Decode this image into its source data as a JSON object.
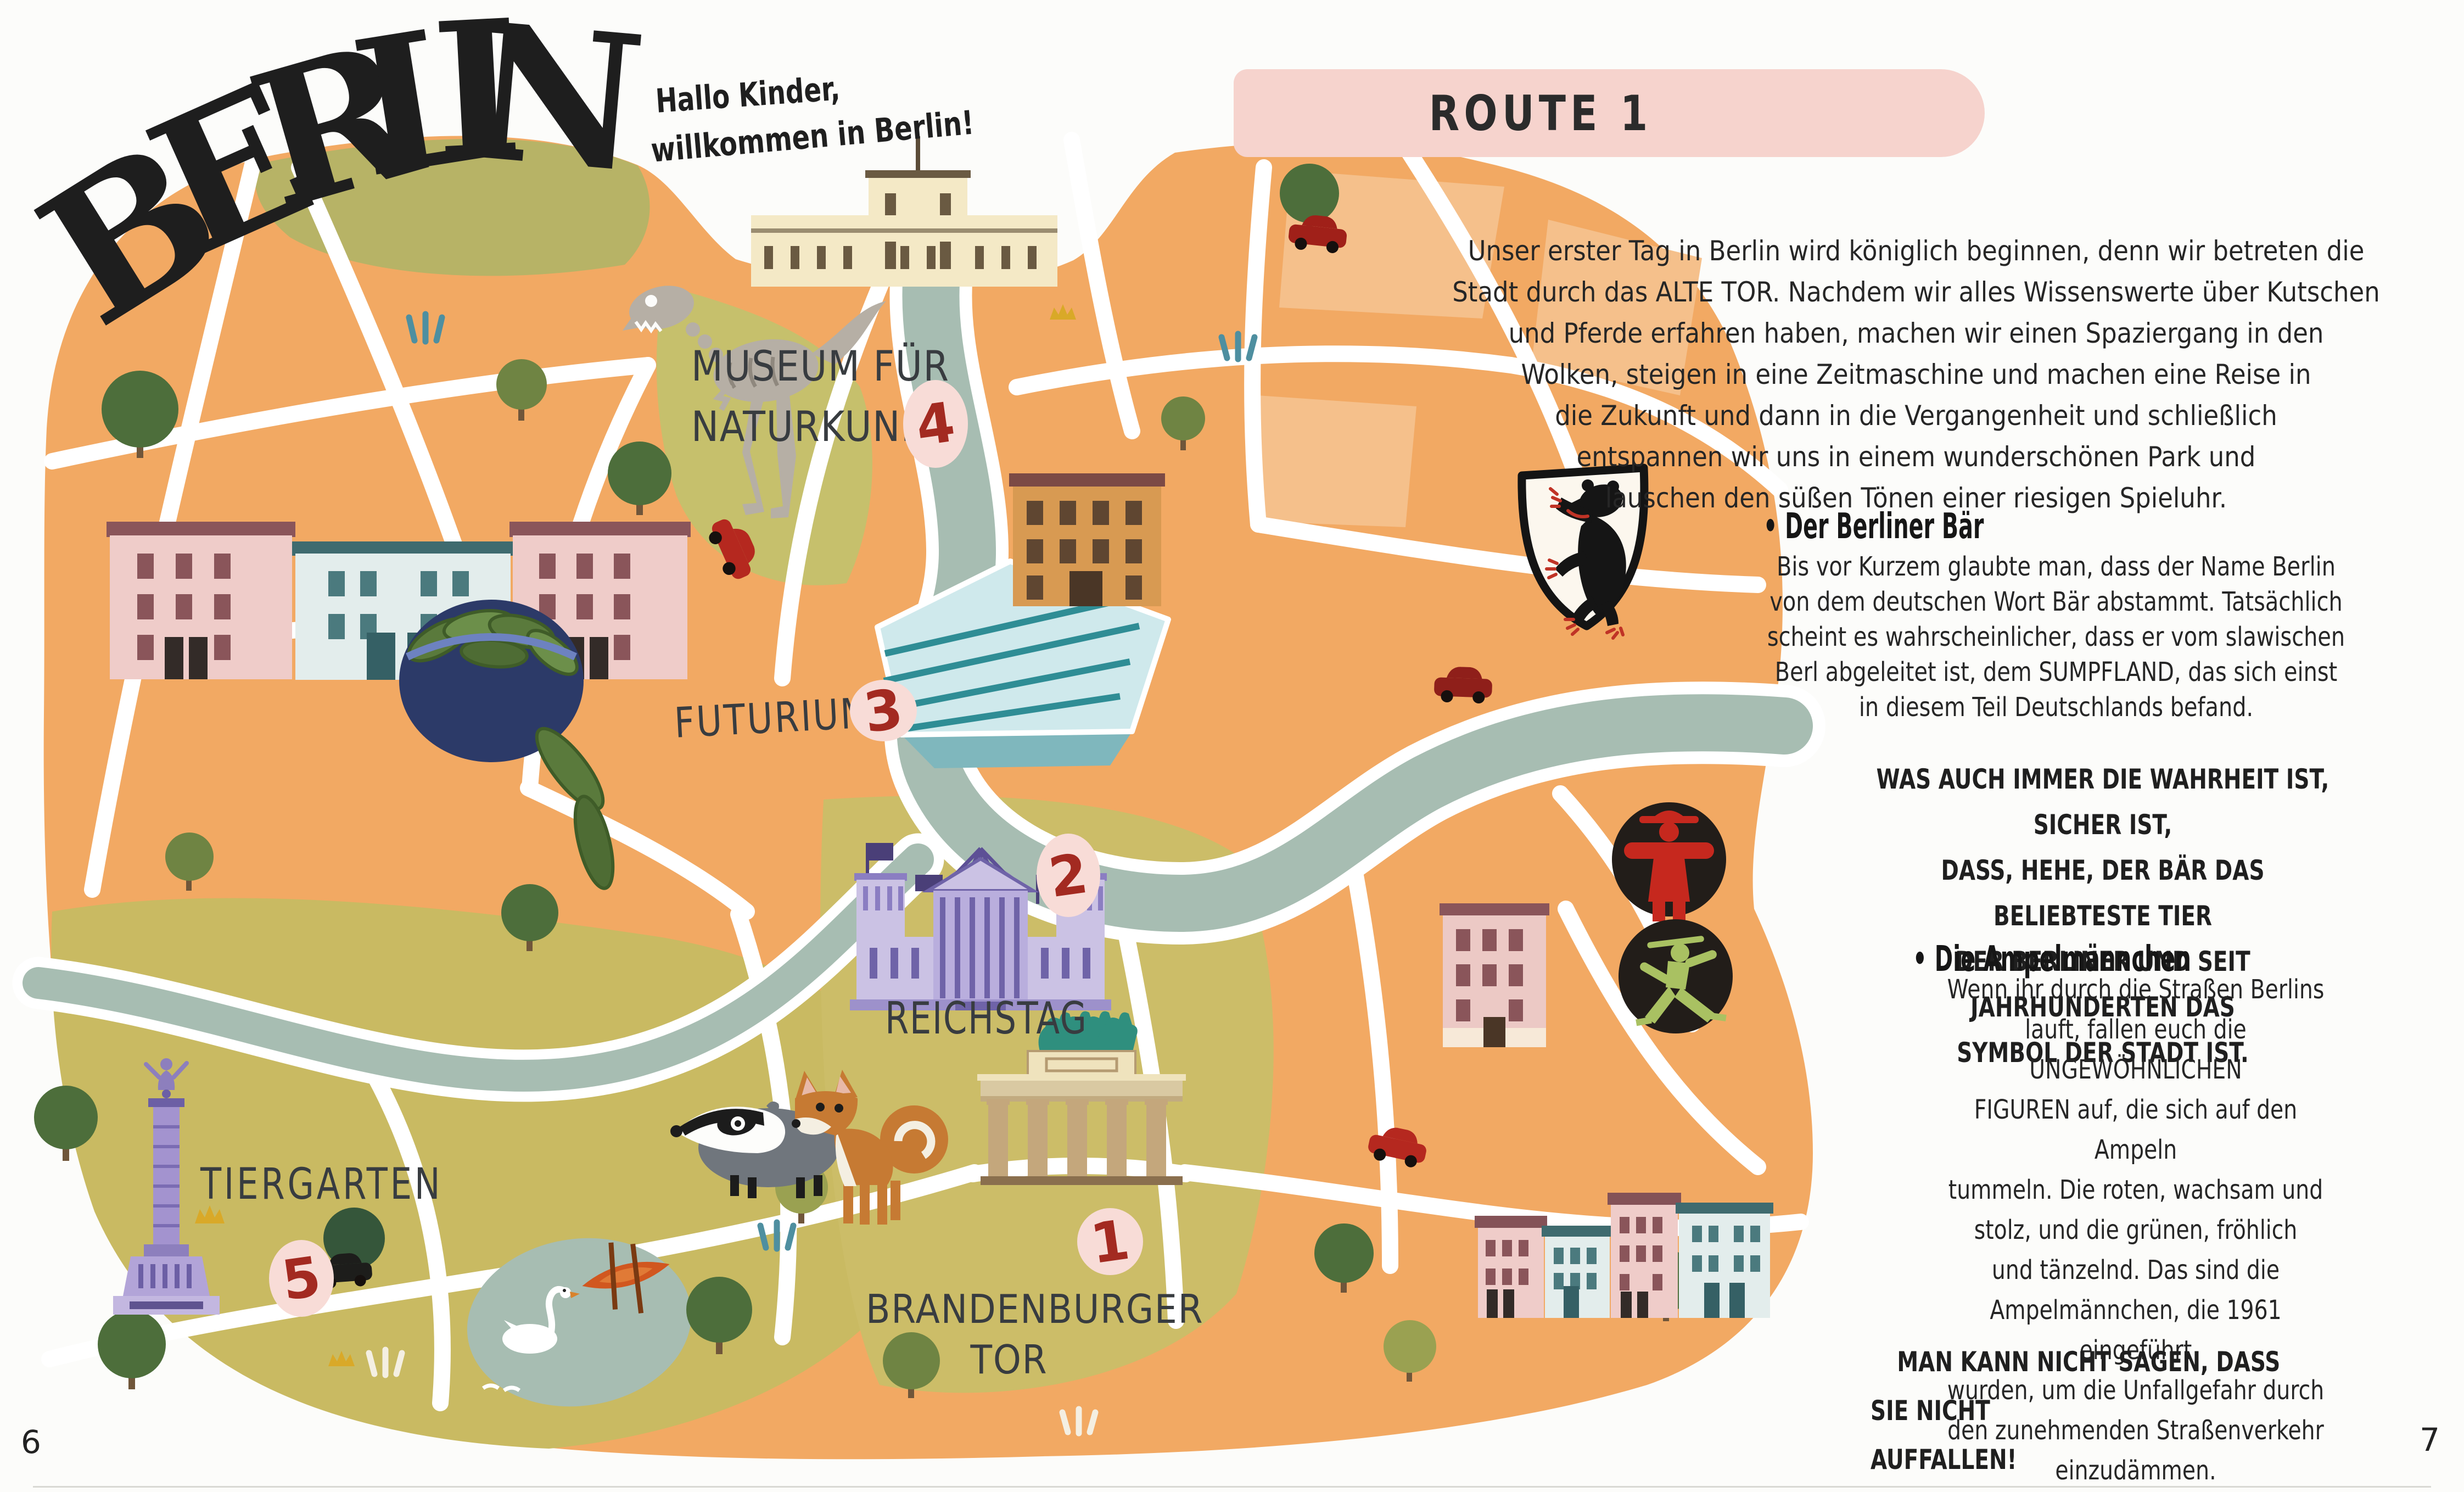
{
  "page": {
    "left_page_number": "6",
    "right_page_number": "7"
  },
  "title": {
    "word": "BERLIN",
    "letters": [
      "B",
      "E",
      "R",
      "L",
      "I",
      "N"
    ]
  },
  "speech": {
    "line1": "Hallo Kinder,",
    "line2": "willkommen in Berlin!"
  },
  "map": {
    "pois": [
      {
        "name": "brandenburger-tor",
        "label": "BRANDENBURGER\nTOR",
        "number": "1"
      },
      {
        "name": "reichstag",
        "label": "REICHSTAG",
        "number": "2"
      },
      {
        "name": "futurium",
        "label": "FUTURIUM",
        "number": "3"
      },
      {
        "name": "museum-fuer-naturkunde",
        "label": "MUSEUM FÜR\nNATURKUNDE",
        "number": "4"
      },
      {
        "name": "tiergarten",
        "label": "TIERGARTEN",
        "number": "5"
      }
    ],
    "icons": [
      "dinosaur-skeleton",
      "natural-history-museum-building",
      "row-houses",
      "pickle-bowl",
      "futurium-building",
      "reichstag-building",
      "brandenburg-gate",
      "victory-column",
      "badger",
      "fox",
      "swan",
      "rowboat",
      "pond",
      "spree-river",
      "berlin-bear-crest",
      "ampelmann-red",
      "ampelmann-green",
      "trees",
      "cars"
    ]
  },
  "route_panel": {
    "header": "ROUTE 1",
    "intro": "Unser erster Tag in Berlin wird königlich beginnen, denn wir betreten die\nStadt durch das ALTE TOR. Nachdem wir alles Wissenswerte über Kutschen\nund Pferde erfahren haben, machen wir einen Spaziergang in den\nWolken, steigen in eine Zeitmaschine und machen eine Reise in\ndie Zukunft und dann in die Vergangenheit und schließlich\nentspannen wir uns in einem wunderschönen Park und\nlauschen den süßen Tönen einer riesigen Spieluhr.",
    "bear_heading": "• Der Berliner Bär",
    "bear_body": "Bis vor Kurzem glaubte man, dass der Name Berlin\nvon dem deutschen Wort Bär abstammt. Tatsächlich\nscheint es wahrscheinlicher, dass er vom slawischen\nBerl abgeleitet ist, dem SUMPFLAND, das sich einst\nin diesem Teil Deutschlands befand.",
    "bear_callout": "WAS AUCH IMMER DIE WAHRHEIT IST, SICHER IST,\nDASS, HEHE, DER BÄR DAS BELIEBTESTE TIER\nDER BERLINER UND SEIT JAHRHUNDERTEN DAS\nSYMBOL DER STADT IST.",
    "ampel_heading": "• Die Ampelmännchen",
    "ampel_body": "Wenn ihr durch die Straßen Berlins\nlauft, fallen euch die UNGEWÖHNLICHEN\nFIGUREN auf, die sich auf den Ampeln\ntummeln. Die roten, wachsam und\nstolz, und die grünen, fröhlich\nund tänzelnd. Das sind die\nAmpelmännchen, die 1961 eingeführt\nwurden, um die Unfallgefahr durch\nden zunehmenden Straßenverkehr\neinzudämmen.",
    "ampel_callout": "MAN KANN NICHT SAGEN, DASS SIE NICHT\nAUFFALLEN!"
  },
  "colors": {
    "map_orange": "#f2a963",
    "map_olive": "#c9ba62",
    "river_teal": "#a7bdb2",
    "pill_pink": "#f6d3cd",
    "poi_pink": "#f8dcd7",
    "poi_number_red": "#a32a21",
    "ampelmann_red": "#c6281e",
    "ampelmann_green": "#a9c162",
    "reichstag_purple": "#8172b5",
    "gate_tan": "#d9c9a2",
    "quadriga_teal": "#2f8f7e"
  }
}
